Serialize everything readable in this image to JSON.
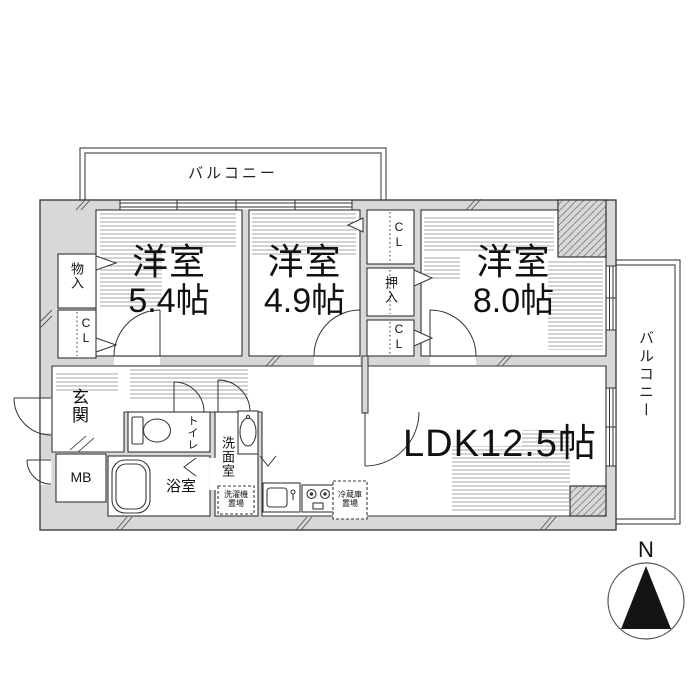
{
  "floorplan": {
    "balconies": {
      "top": "バルコニー",
      "right": "バルコニー"
    },
    "rooms": {
      "bedroom1_name": "洋室",
      "bedroom1_size": "5.4帖",
      "bedroom2_name": "洋室",
      "bedroom2_size": "4.9帖",
      "bedroom3_name": "洋室",
      "bedroom3_size": "8.0帖",
      "ldk": "LDK12.5帖",
      "genkan": "玄関",
      "toilet": "トイレ",
      "bath": "浴室",
      "washroom": "洗面室"
    },
    "storage": {
      "monoire": "物入",
      "cl_left": "CL",
      "cl_top": "CL",
      "oshiire": "押入",
      "cl_mid": "CL",
      "mb": "MB"
    },
    "equipment": {
      "washer_line1": "洗濯機",
      "washer_line2": "置場",
      "fridge_line1": "冷蔵庫",
      "fridge_line2": "置場"
    },
    "compass": {
      "north": "N"
    },
    "colors": {
      "wall_fill": "#d8d8d8",
      "line": "#333333"
    }
  }
}
